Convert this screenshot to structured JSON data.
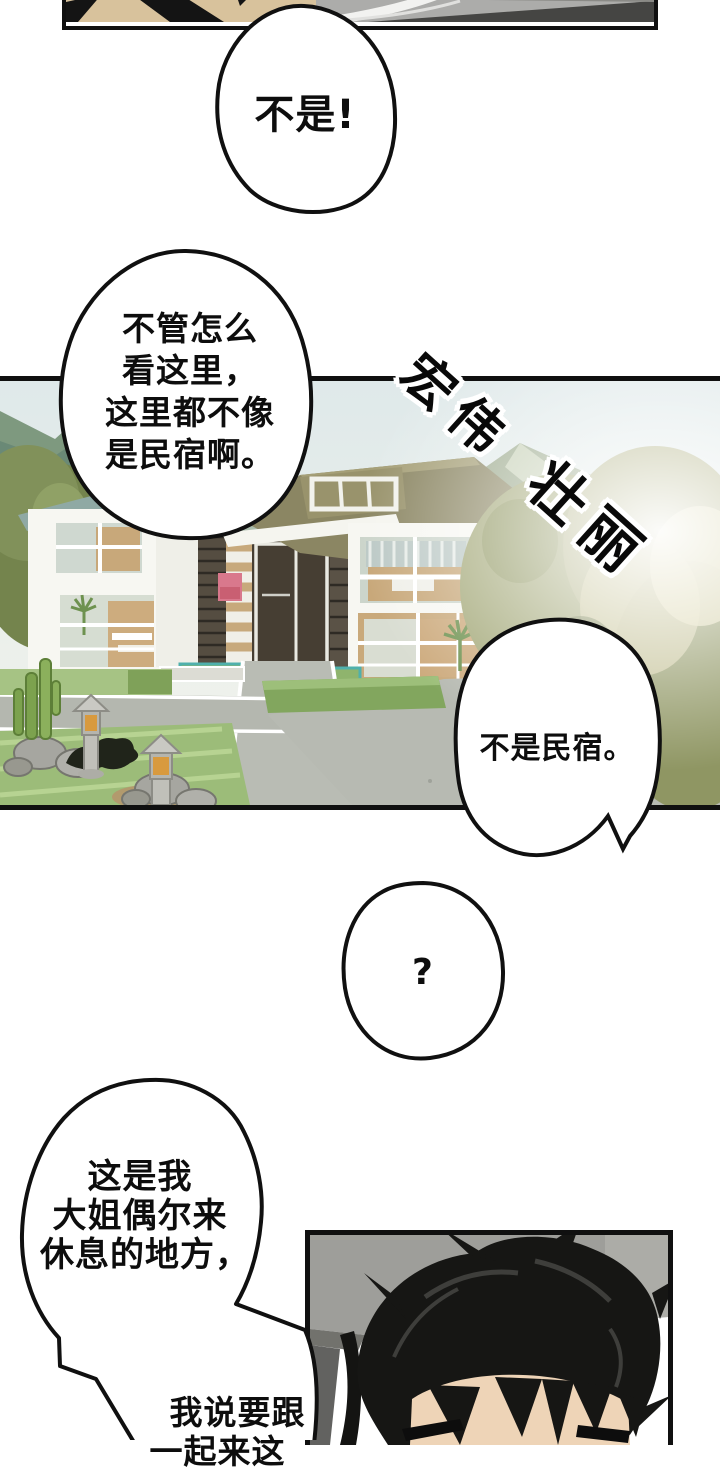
{
  "comic": {
    "bubble_exclaim": "不是!",
    "bubble_doubt": [
      "不管怎么",
      "看这里，",
      "这里都不像",
      "是民宿啊。"
    ],
    "sfx_word1": "宏伟",
    "sfx_word2": "壮丽",
    "bubble_deny": "不是民宿。",
    "bubble_question": "?",
    "bubble_explain": [
      "这是我",
      "大姐偶尔来",
      "休息的地方，"
    ],
    "bubble_explain_cont": [
      "我说要跟",
      "一起来这"
    ]
  },
  "colors": {
    "ink": "#101010",
    "paper": "#ffffff",
    "sky": "#e7eeea",
    "mountain": "#7e997f",
    "roof": "#8b8663",
    "grass": "#9cbc79",
    "path": "#b7bab2",
    "lantern_glow": "#d89a3e",
    "wall_gray": "#9e9e9a",
    "skin": "#eed4b7",
    "accent_pink": "#d9788c"
  }
}
